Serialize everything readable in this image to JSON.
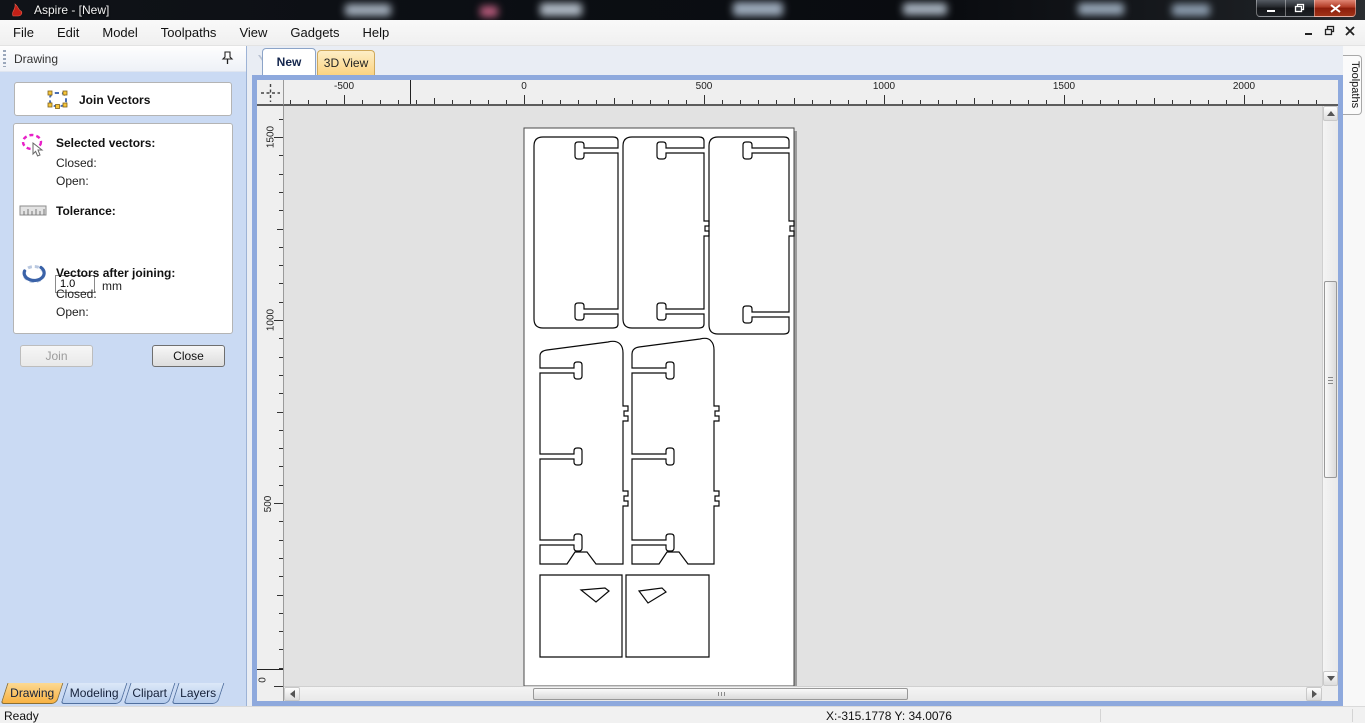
{
  "window": {
    "title": "Aspire - [New]"
  },
  "menu": {
    "items": [
      "File",
      "Edit",
      "Model",
      "Toolpaths",
      "View",
      "Gadgets",
      "Help"
    ]
  },
  "panel": {
    "header": "Drawing",
    "tool_title": "Join Vectors",
    "selected": {
      "heading": "Selected vectors:",
      "closed": "Closed:",
      "open": "Open:"
    },
    "tolerance": {
      "heading": "Tolerance:",
      "value": "1.0",
      "unit": "mm"
    },
    "after": {
      "heading": "Vectors after joining:",
      "closed": "Closed:",
      "open": "Open:"
    },
    "buttons": {
      "join": "Join",
      "close": "Close"
    },
    "tabs": [
      {
        "label": "Drawing",
        "active": true
      },
      {
        "label": "Modeling",
        "active": false
      },
      {
        "label": "Clipart",
        "active": false
      },
      {
        "label": "Layers",
        "active": false
      }
    ]
  },
  "view_tabs": [
    {
      "label": "New",
      "active": true
    },
    {
      "label": "3D View",
      "active": false
    }
  ],
  "right_tab": "Toolpaths",
  "status": {
    "ready": "Ready",
    "coords": "X:-315.1778 Y: 34.0076"
  },
  "rulers": {
    "horizontal": {
      "labels": [
        {
          "text": "-500",
          "x": 60
        },
        {
          "text": "0",
          "x": 240
        },
        {
          "text": "500",
          "x": 420
        },
        {
          "text": "1000",
          "x": 600
        },
        {
          "text": "1500",
          "x": 780
        },
        {
          "text": "2000",
          "x": 960
        }
      ],
      "ticks": {
        "origin": 60,
        "step": 18,
        "count_before": 3,
        "count_after": 55
      },
      "cursor_px": 126
    },
    "vertical": {
      "labels": [
        {
          "text": "1500",
          "y": 31
        },
        {
          "text": "1000",
          "y": 214
        },
        {
          "text": "500",
          "y": 398
        },
        {
          "text": "0",
          "y": 574
        }
      ],
      "ticks": {
        "origin": 31,
        "step": 18.3,
        "count_before": 2,
        "count_after": 31
      },
      "cursor_px": 563
    }
  },
  "canvas": {
    "viewbox": "0 0 1038 580",
    "background": "#e2e2e2",
    "sheet": {
      "x": 240,
      "y": 22,
      "w": 270,
      "h": 558,
      "fill": "#ffffff",
      "stroke": "#4a4a4a"
    },
    "stroke": "#0a0a0a",
    "shapes": [
      {
        "name": "top-panel-1",
        "d": "M 259 31 H 329 Q 334 31 334 35 V 42 H 300 V 39 Q 300 36 297 36 H 294 Q 291 36 291 39 V 50 Q 291 53 294 53 H 297 Q 300 53 300 50 V 47 H 334 V 203 H 300 V 200 Q 300 197 297 197 H 294 Q 291 197 291 200 V 211 Q 291 214 294 214 H 297 Q 300 214 300 211 V 208 H 334 V 218 Q 334 222 329 222 H 259 Q 250 222 250 213 V 40 Q 250 31 259 31 Z"
      },
      {
        "name": "top-panel-2",
        "d": "M 348 31 H 415 Q 420 31 420 35 V 42 H 382 V 39 Q 382 36 379 36 H 376 Q 373 36 373 39 V 50 Q 373 53 376 53 H 379 Q 382 53 382 50 V 47 H 420 V 115 H 425 V 120 H 421 V 125 H 425 V 130 H 420 V 203 H 382 V 200 Q 382 197 379 197 H 376 Q 373 197 373 200 V 211 Q 373 214 376 214 H 379 Q 382 214 382 211 V 208 H 420 V 218 Q 420 222 415 222 H 348 Q 339 222 339 213 V 40 Q 339 31 348 31 Z"
      },
      {
        "name": "top-panel-3",
        "d": "M 434 31 H 500 Q 505 31 505 35 V 42 H 468 V 39 Q 468 36 465 36 H 462 Q 459 36 459 39 V 50 Q 459 53 462 53 H 465 Q 468 53 468 50 V 47 H 505 V 115 H 510 V 120 H 506 V 125 H 510 V 130 H 505 V 206 H 468 V 203 Q 468 200 465 200 H 462 Q 459 200 459 203 V 214 Q 459 217 462 217 H 465 Q 468 217 468 214 V 211 H 505 V 224 Q 505 228 500 228 H 434 Q 425 228 425 219 V 40 Q 425 31 434 31 Z"
      },
      {
        "name": "side-panel-1",
        "d": "M 263 244 L 324 236 Q 332 234 336 238 Q 339 241 339 247 V 300 H 344 V 305 H 340 V 310 H 344 V 315 H 339 V 385 H 344 V 390 H 340 V 395 H 344 V 400 H 339 V 458 H 312 L 303 446 H 291 L 283 458 H 256 V 439 H 290 V 442 Q 290 445 293 445 H 295 Q 298 445 298 442 V 431 Q 298 428 295 428 H 293 Q 290 428 290 431 V 434 H 256 V 353 H 290 V 356 Q 290 359 293 359 H 295 Q 298 359 298 356 V 345 Q 298 342 295 342 H 293 Q 290 342 290 345 V 348 H 256 V 267 H 290 V 270 Q 290 273 293 273 H 295 Q 298 273 298 270 V 259 Q 298 256 295 256 H 293 Q 290 256 290 259 V 262 H 256 V 250 Q 256 245 263 244 Z"
      },
      {
        "name": "side-panel-2",
        "d": "M 355 241 L 416 233 Q 424 231 427 235 Q 430 238 430 244 V 300 H 435 V 305 H 431 V 310 H 435 V 315 H 430 V 385 H 435 V 390 H 431 V 395 H 435 V 400 H 430 V 458 H 404 L 395 446 H 383 L 375 458 H 348 V 439 H 382 V 442 Q 382 445 385 445 H 387 Q 390 445 390 442 V 431 Q 390 428 387 428 H 385 Q 382 428 382 431 V 434 H 348 V 353 H 382 V 356 Q 382 359 385 359 H 387 Q 390 359 390 356 V 345 Q 390 342 387 342 H 385 Q 382 342 382 345 V 348 H 348 V 267 H 382 V 270 Q 382 273 385 273 H 387 Q 390 273 390 270 V 259 Q 390 256 387 256 H 385 Q 382 256 382 259 V 262 H 348 V 248 Q 348 242 355 241 Z"
      },
      {
        "name": "shelf-1",
        "d": "M 256 469 H 338 V 551 H 256 Z M 297 484 L 321 482 L 325 485 L 312 496 Z"
      },
      {
        "name": "shelf-2",
        "d": "M 342 469 H 425 V 551 H 342 Z M 355 485 L 378 482 L 382 486 L 364 497 Z"
      }
    ]
  },
  "scrollbars": {
    "vertical": {
      "thumb_top": 175,
      "thumb_height": 197
    },
    "horizontal": {
      "thumb_left": 249,
      "thumb_width": 375
    }
  },
  "colors": {
    "accent_blue": "#8ea9dd",
    "panel_blue": "#cadaf3",
    "tab_orange": "#f8b243",
    "select_magenta": "#e821c7",
    "vector_blue": "#3a62a8"
  }
}
